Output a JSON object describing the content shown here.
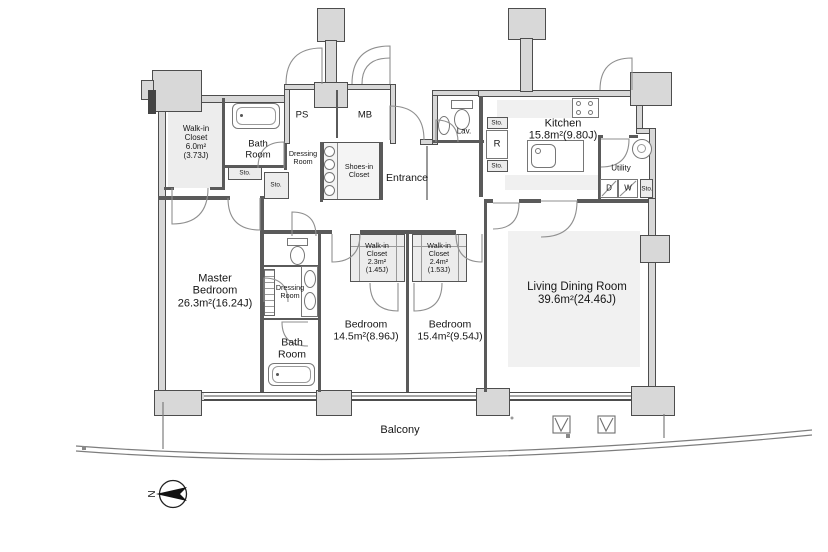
{
  "labels": {
    "walk_in_closet_main": "Walk-in\nCloset\n6.0m²\n(3.73J)",
    "bath_room_main": "Bath\nRoom",
    "ps": "PS",
    "mb": "MB",
    "dressing_room_entry": "Dressing\nRoom",
    "shoes_in_closet": "Shoes-in\nCloset",
    "entrance": "Entrance",
    "lavatory": "Lav.",
    "storage": "Sto.",
    "refrigerator": "R",
    "kitchen": "Kitchen\n15.8m²(9.80J)",
    "utility": "Utility",
    "dryer": "D",
    "washer": "W",
    "master_bedroom": "Master\nBedroom\n26.3m²(16.24J)",
    "dressing_room_master": "Dressing\nRoom",
    "bath_room_master": "Bath\nRoom",
    "walk_in_closet_23": "Walk-in\nCloset\n2.3m²\n(1.45J)",
    "walk_in_closet_24": "Walk-in\nCloset\n2.4m²\n(1.53J)",
    "bedroom_145": "Bedroom\n14.5m²(8.96J)",
    "bedroom_154": "Bedroom\n15.4m²(9.54J)",
    "living_dining": "Living Dining Room\n39.6m²(24.46J)",
    "balcony": "Balcony"
  },
  "compass": {
    "label": "N"
  },
  "colors": {
    "wall_fill": "#d8d8d8",
    "wall_line": "#4d4d4d",
    "closet_fill": "#ececec",
    "floor_patch": "#f1f1f1"
  }
}
